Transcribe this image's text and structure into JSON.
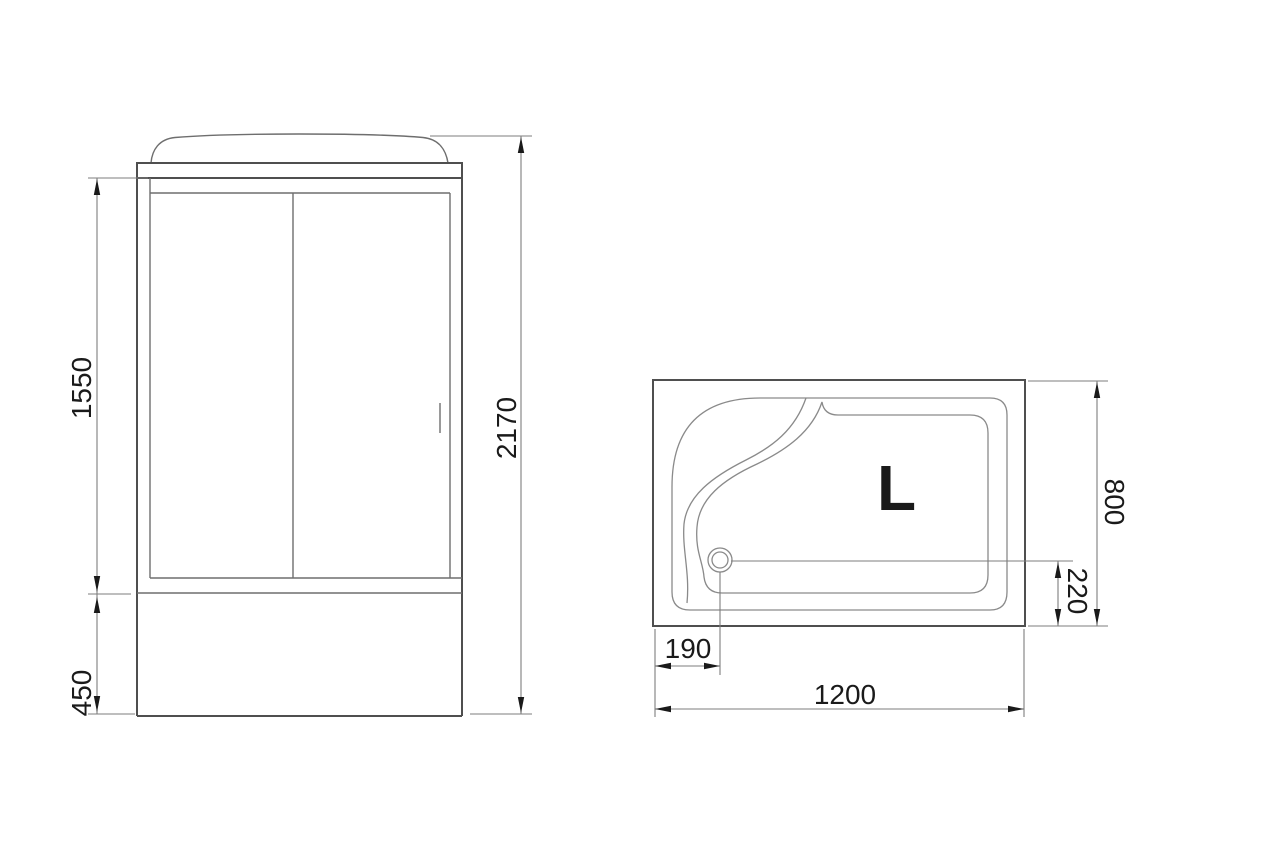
{
  "page": {
    "background": "#ffffff"
  },
  "colors": {
    "outline": "#4f4f4f",
    "inner_line": "#6e6e6e",
    "curve_line": "#8a8a8a",
    "dimension_line": "#7d7d7d",
    "text": "#1a1a1a"
  },
  "front_view": {
    "dims": {
      "glass_height": "1550",
      "base_height": "450",
      "total_height": "2170"
    }
  },
  "plan_view": {
    "orientation_label": "L",
    "dims": {
      "depth": "800",
      "drain_offset_bottom": "220",
      "drain_offset_left": "190",
      "width": "1200"
    }
  }
}
